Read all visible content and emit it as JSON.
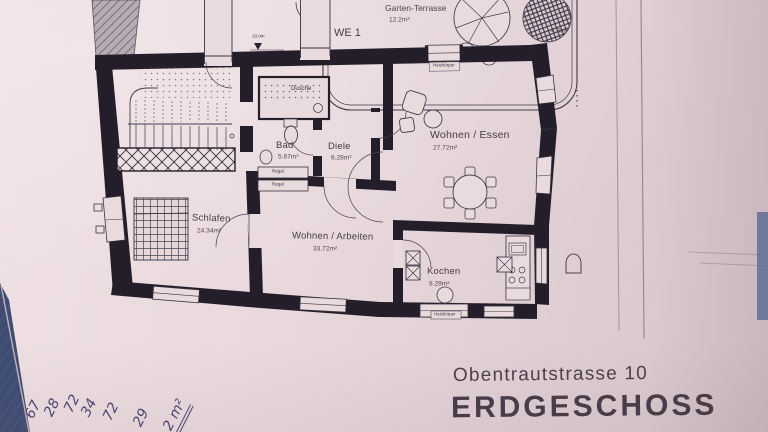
{
  "plan": {
    "unit": "WE 1",
    "terrace": {
      "name": "Garten-Terrasse",
      "area": "12.2m²"
    },
    "tree_area": "4.3m²",
    "elevation": "±0.0m",
    "rooms": {
      "schlafen": {
        "name": "Schlafen",
        "area": "24.34m²"
      },
      "bad": {
        "name": "Bad",
        "area": "5.67m²"
      },
      "diele": {
        "name": "Diele",
        "area": "6.28m²"
      },
      "wohnen_arbeiten": {
        "name": "Wohnen / Arbeiten",
        "area": "33.72m²"
      },
      "wohnen_essen": {
        "name": "Wohnen / Essen",
        "area": "27.72m²"
      },
      "kochen": {
        "name": "Kochen",
        "area": "8.29m²"
      },
      "dusche": {
        "name": "Dusche"
      }
    },
    "fixtures": {
      "radiator": "Heizkörper",
      "shelf": "Regal"
    }
  },
  "title_block": {
    "street": "Obentrautstrasse 10",
    "floor": "ERDGESCHOSS"
  },
  "handwriting": {
    "values": [
      "67",
      "28",
      "72",
      "34",
      "72",
      "29"
    ],
    "sum": "2 m²"
  },
  "colors": {
    "paper": "#e9dadd",
    "ink": "#25202b",
    "denim": "#3e4c72",
    "pen": "#4b4270"
  }
}
